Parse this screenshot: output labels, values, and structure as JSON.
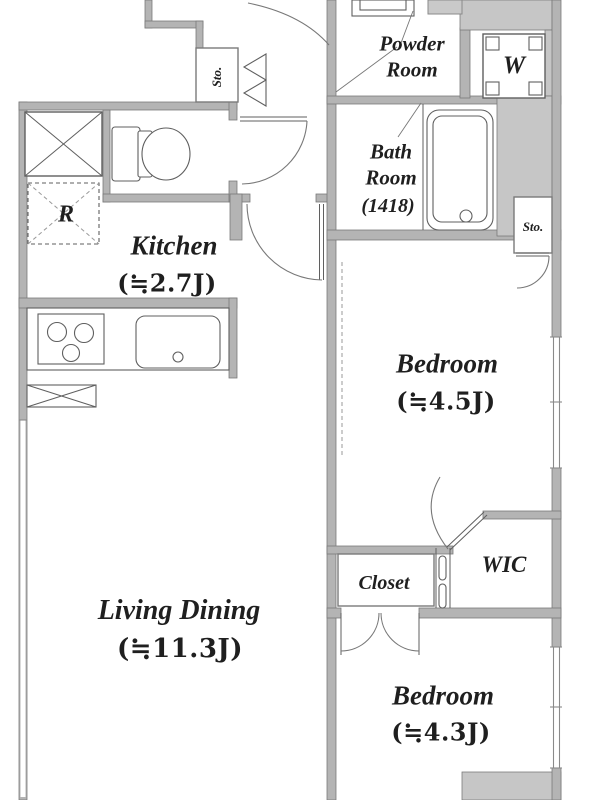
{
  "colors": {
    "background": "#ffffff",
    "wall": "#b4b4b4",
    "wall_edge": "#7a7a7a",
    "poche": "#c6c6c6",
    "line": "#5f5f5f",
    "text": "#1f1f1f"
  },
  "plan": {
    "rooms": {
      "powder_room": {
        "name": "Powder\nRoom"
      },
      "bath_room": {
        "name": "Bath\nRoom",
        "size": "(1418)"
      },
      "kitchen": {
        "name": "Kitchen",
        "size": "(≒2.7J)"
      },
      "living_dining": {
        "name": "Living Dining",
        "size": "(≒11.3J)"
      },
      "bedroom_main": {
        "name": "Bedroom",
        "size": "(≒4.5J)"
      },
      "bedroom_second": {
        "name": "Bedroom",
        "size": "(≒4.3J)"
      },
      "closet": {
        "name": "Closet"
      },
      "wic": {
        "name": "WIC"
      }
    },
    "fixtures": {
      "washer": "W",
      "refrigerator": "R",
      "storage_hall": "Sto.",
      "storage_bedroom": "Sto."
    }
  }
}
